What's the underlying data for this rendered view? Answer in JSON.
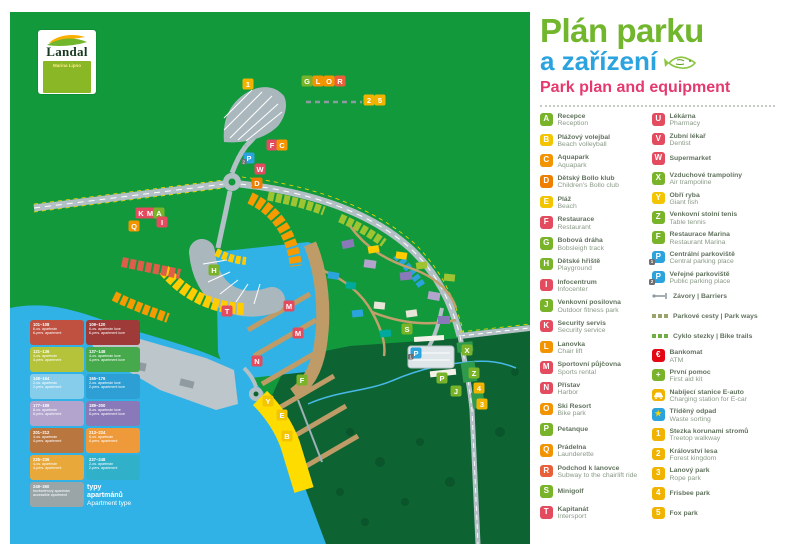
{
  "logo": {
    "brand": "Landal",
    "park": "Marina Lipno"
  },
  "title": {
    "line1": "Plán parku",
    "line2": "a zařízení",
    "line3": "Park plan and equipment"
  },
  "colors": {
    "green": "#79b329",
    "yellow": "#f3c500",
    "orange": "#f29400",
    "darkorange": "#ee7d00",
    "crimson": "#e34b5f",
    "redorange": "#e8603a",
    "red": "#e30613",
    "blue": "#2ba3dc",
    "amber": "#f0b400",
    "map_green": "#12993c",
    "map_darkgreen": "#0d6432",
    "water": "#31b2e6",
    "road": "#b3c0c6",
    "pier": "#bf9c67"
  },
  "legend": {
    "left": [
      {
        "id": "A",
        "color": "green",
        "cz": "Recepce",
        "en": "Reception"
      },
      {
        "id": "B",
        "color": "yellow",
        "cz": "Plážový volejbal",
        "en": "Beach volleyball"
      },
      {
        "id": "C",
        "color": "orange",
        "cz": "Aquapark",
        "en": "Aquapark"
      },
      {
        "id": "D",
        "color": "darkorange",
        "cz": "Dětský Bollo klub",
        "en": "Children's Bollo club"
      },
      {
        "id": "E",
        "color": "yellow",
        "cz": "Pláž",
        "en": "Beach"
      },
      {
        "id": "F",
        "color": "crimson",
        "cz": "Restaurace",
        "en": "Restaurant"
      },
      {
        "id": "G",
        "color": "green",
        "cz": "Bobová dráha",
        "en": "Bobsleigh track"
      },
      {
        "id": "H",
        "color": "green",
        "cz": "Dětské hřiště",
        "en": "Playground"
      },
      {
        "id": "I",
        "color": "crimson",
        "cz": "Infocentrum",
        "en": "Infocenter"
      },
      {
        "id": "J",
        "color": "green",
        "cz": "Venkovní posilovna",
        "en": "Outdoor fitness park"
      },
      {
        "id": "K",
        "color": "crimson",
        "cz": "Security servis",
        "en": "Security service"
      },
      {
        "id": "L",
        "color": "orange",
        "cz": "Lanovka",
        "en": "Chair lift"
      },
      {
        "id": "M",
        "color": "crimson",
        "cz": "Sportovní půjčovna",
        "en": "Sports rental"
      },
      {
        "id": "N",
        "color": "crimson",
        "cz": "Přístav",
        "en": "Harbor"
      },
      {
        "id": "O",
        "color": "orange",
        "cz": "Ski Resort",
        "en": "Bike park"
      },
      {
        "id": "P",
        "color": "green",
        "cz": "Petanque",
        "en": ""
      },
      {
        "id": "Q",
        "color": "orange",
        "cz": "Prádelna",
        "en": "Launderette"
      },
      {
        "id": "R",
        "color": "redorange",
        "cz": "Podchod k lanovce",
        "en": "Subway to the chairlift ride"
      },
      {
        "id": "S",
        "color": "green",
        "cz": "Minigolf",
        "en": ""
      },
      {
        "id": "T",
        "color": "crimson",
        "cz": "Kapitanát",
        "en": "Intersport"
      }
    ],
    "right": [
      {
        "id": "U",
        "color": "crimson",
        "cz": "Lékárna",
        "en": "Pharmacy"
      },
      {
        "id": "V",
        "color": "crimson",
        "cz": "Zubní lékař",
        "en": "Dentist"
      },
      {
        "id": "W",
        "color": "crimson",
        "cz": "Supermarket",
        "en": ""
      },
      {
        "id": "X",
        "color": "green",
        "cz": "Vzduchové trampolíny",
        "en": "Air trampoline"
      },
      {
        "id": "Y",
        "color": "yellow",
        "cz": "Obří ryba",
        "en": "Giant fish"
      },
      {
        "id": "Z",
        "color": "green",
        "cz": "Venkovní stolní tenis",
        "en": "Table tennis"
      },
      {
        "id": "F",
        "color": "green",
        "cz": "Restaurace Marina",
        "en": "Restaurant Marina"
      },
      {
        "id": "P",
        "badge": "1",
        "color": "blue",
        "cz": "Centrální parkoviště",
        "en": "Central parking place"
      },
      {
        "id": "P",
        "badge": "2",
        "color": "blue",
        "cz": "Veřejné parkoviště",
        "en": "Public parking place"
      },
      {
        "icon": "barrier-icon",
        "cz": "Závory | Barriers",
        "en": ""
      },
      {
        "icon": "parkway-icon",
        "cz": "Parkové cesty | Park ways",
        "en": ""
      },
      {
        "icon": "biketrail-icon",
        "cz": "Cyklo stezky | Bike trails",
        "en": ""
      },
      {
        "icon": "euro-icon",
        "color": "red",
        "cz": "Bankomat",
        "en": "ATM"
      },
      {
        "icon": "plus-icon",
        "color": "green",
        "cz": "První pomoc",
        "en": "First aid kit"
      },
      {
        "icon": "ecar-icon",
        "color": "amber",
        "cz": "Nabíjecí stanice E-auto",
        "en": "Charging station for E-car"
      },
      {
        "icon": "star-icon",
        "color": "blue",
        "cz": "Tříděný odpad",
        "en": "Waste sorting"
      },
      {
        "id": "1",
        "color": "amber",
        "cz": "Stezka korunami stromů",
        "en": "Treetop walkway"
      },
      {
        "id": "2",
        "color": "amber",
        "cz": "Království lesa",
        "en": "Forest kingdom"
      },
      {
        "id": "3",
        "color": "amber",
        "cz": "Lanový park",
        "en": "Rope park"
      },
      {
        "id": "4",
        "color": "amber",
        "cz": "Frisbee park",
        "en": ""
      },
      {
        "id": "5",
        "color": "amber",
        "cz": "Fox park",
        "en": ""
      }
    ]
  },
  "map": {
    "markers": [
      {
        "l": "1",
        "c": "amber",
        "x": 238,
        "y": 72
      },
      {
        "l": "G",
        "c": "green",
        "x": 297,
        "y": 69
      },
      {
        "l": "L",
        "c": "orange",
        "x": 308,
        "y": 69
      },
      {
        "l": "O",
        "c": "orange",
        "x": 319,
        "y": 69
      },
      {
        "l": "R",
        "c": "redorange",
        "x": 330,
        "y": 69
      },
      {
        "l": "2",
        "c": "amber",
        "x": 359,
        "y": 88
      },
      {
        "l": "5",
        "c": "amber",
        "x": 370,
        "y": 88
      },
      {
        "l": "F",
        "c": "crimson",
        "x": 262,
        "y": 133
      },
      {
        "l": "C",
        "c": "orange",
        "x": 272,
        "y": 133
      },
      {
        "l": "P",
        "c": "blue",
        "x": 239,
        "y": 146,
        "b": "2"
      },
      {
        "l": "W",
        "c": "crimson",
        "x": 250,
        "y": 157
      },
      {
        "l": "D",
        "c": "darkorange",
        "x": 247,
        "y": 171
      },
      {
        "l": "K",
        "c": "crimson",
        "x": 131,
        "y": 201
      },
      {
        "l": "M",
        "c": "crimson",
        "x": 140,
        "y": 201
      },
      {
        "l": "A",
        "c": "green",
        "x": 149,
        "y": 201
      },
      {
        "l": "I",
        "c": "crimson",
        "x": 152,
        "y": 210
      },
      {
        "l": "Q",
        "c": "orange",
        "x": 124,
        "y": 214
      },
      {
        "l": "H",
        "c": "green",
        "x": 204,
        "y": 258
      },
      {
        "l": "T",
        "c": "crimson",
        "x": 217,
        "y": 299
      },
      {
        "l": "M",
        "c": "crimson",
        "x": 279,
        "y": 294
      },
      {
        "l": "M",
        "c": "crimson",
        "x": 288,
        "y": 321
      },
      {
        "l": "N",
        "c": "crimson",
        "x": 247,
        "y": 349
      },
      {
        "l": "F",
        "c": "green",
        "x": 292,
        "y": 368
      },
      {
        "l": "Y",
        "c": "yellow",
        "x": 258,
        "y": 389
      },
      {
        "l": "E",
        "c": "yellow",
        "x": 272,
        "y": 403
      },
      {
        "l": "B",
        "c": "yellow",
        "x": 277,
        "y": 424
      },
      {
        "l": "S",
        "c": "green",
        "x": 397,
        "y": 317
      },
      {
        "l": "P",
        "c": "blue",
        "x": 406,
        "y": 341,
        "b": "1"
      },
      {
        "l": "P",
        "c": "green",
        "x": 432,
        "y": 366
      },
      {
        "l": "X",
        "c": "green",
        "x": 457,
        "y": 338
      },
      {
        "l": "Z",
        "c": "green",
        "x": 464,
        "y": 361
      },
      {
        "l": "J",
        "c": "green",
        "x": 446,
        "y": 379
      },
      {
        "l": "4",
        "c": "amber",
        "x": 469,
        "y": 376
      },
      {
        "l": "3",
        "c": "amber",
        "x": 472,
        "y": 392
      }
    ],
    "apartment_legend": {
      "caption_cz": "typy apartmánů",
      "caption_en": "Apartment type",
      "blocks": [
        {
          "color": "#c0503f",
          "range": "101–108",
          "cz": "6-os. apartmán",
          "en": "6-pers. apartment"
        },
        {
          "color": "#9e3a37",
          "range": "109–120",
          "cz": "6-os. apartmán luxe",
          "en": "6-pers. apartment luxe"
        },
        {
          "color": "#b5c33a",
          "range": "121–136",
          "cz": "4-os. apartmán",
          "en": "4-pers. apartment"
        },
        {
          "color": "#46a94b",
          "range": "137–148",
          "cz": "4-os. apartmán luxe",
          "en": "4-pers. apartment luxe"
        },
        {
          "color": "#86cdec",
          "range": "149–164",
          "cz": "2-os. apartmán",
          "en": "2-pers. apartment"
        },
        {
          "color": "#2e9fd4",
          "range": "165–176",
          "cz": "2-os. apartmán luxe",
          "en": "2-pers. apartment luxe"
        },
        {
          "color": "#b2a4cd",
          "range": "177–188",
          "cz": "8-os. apartmán",
          "en": "8-pers. apartment"
        },
        {
          "color": "#8a79b8",
          "range": "189–200",
          "cz": "8-os. apartmán luxe",
          "en": "8-pers. apartment luxe"
        },
        {
          "color": "#b9763f",
          "range": "201–212",
          "cz": "4-os. apartmán",
          "en": "4-pers. apartment"
        },
        {
          "color": "#ef9a3a",
          "range": "213–224",
          "cz": "6-os. apartmán",
          "en": "6-pers. apartment"
        },
        {
          "color": "#e8a83a",
          "range": "225–236",
          "cz": "4-os. apartmán",
          "en": "4-pers. apartment"
        },
        {
          "color": "#31b0c9",
          "range": "237–248",
          "cz": "2-os. apartmán",
          "en": "2-pers. apartment"
        },
        {
          "color": "#9aa5a8",
          "range": "249–260",
          "cz": "bezbariérový apartmán",
          "en": "accessible apartment"
        }
      ]
    }
  }
}
